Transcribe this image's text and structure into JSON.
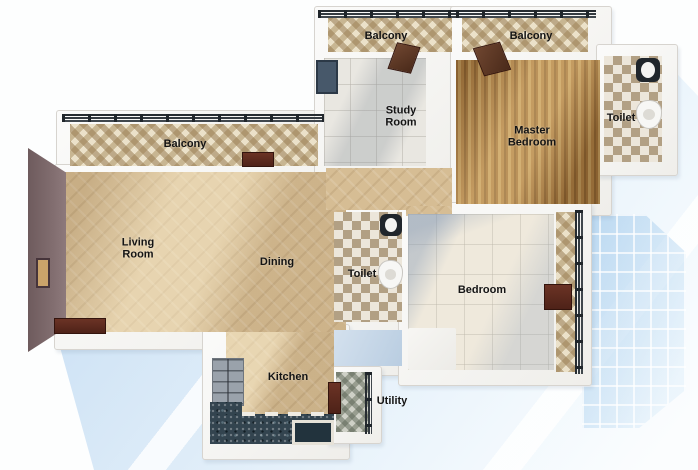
{
  "floorplan": {
    "rooms": {
      "balcony_living": {
        "label": "Balcony"
      },
      "balcony_study": {
        "label": "Balcony"
      },
      "balcony_master": {
        "label": "Balcony"
      },
      "study": {
        "label": "Study Room"
      },
      "master_bedroom": {
        "label": "Master Bedroom"
      },
      "toilet_master": {
        "label": "Toilet"
      },
      "living": {
        "label": "Living Room"
      },
      "dining": {
        "label": "Dining"
      },
      "toilet_common": {
        "label": "Toilet"
      },
      "bedroom": {
        "label": "Bedroom"
      },
      "kitchen": {
        "label": "Kitchen"
      },
      "utility": {
        "label": "Utility"
      }
    },
    "colors": {
      "wall": "#f7f6f3",
      "accent_wall": "#7d696b",
      "floor_tile": "#d6bd94",
      "wood_floor": "#b5874a",
      "white_tile": "#e9e7e1",
      "cream_tile": "#efe9dc",
      "checker_tile": "#b2a084",
      "balcony_tile": "#d8c9a5",
      "granite_counter": "#33444f",
      "door": "#5e2d21",
      "railing": "#23282c",
      "shadow_blue": "#cfe4f6"
    }
  }
}
